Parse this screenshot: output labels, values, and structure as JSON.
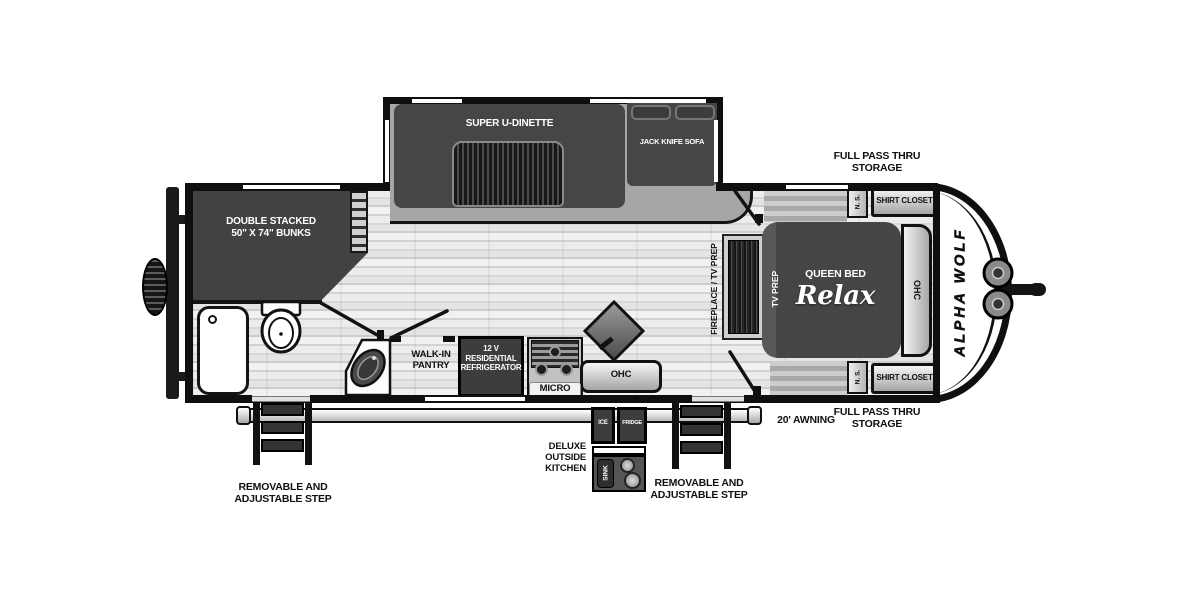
{
  "page": {
    "title": "Alpha Wolf travel trailer floor plan"
  },
  "colors": {
    "wall": "#0f0f0f",
    "furniture_dark": "#454545",
    "slide_floor": "#a6a6a6",
    "floor_light": "#e3e3e3"
  },
  "slide_out": {
    "dinette_label": "SUPER U-DINETTE",
    "sofa_label": "JACK KNIFE SOFA"
  },
  "bunk_room": {
    "line1": "DOUBLE STACKED",
    "line2": "50\" X 74\" BUNKS"
  },
  "kitchen": {
    "pantry_line1": "WALK-IN",
    "pantry_line2": "PANTRY",
    "fridge_line1": "12 V",
    "fridge_line2": "RESIDENTIAL",
    "fridge_line3": "REFRIGERATOR",
    "micro_label": "MICRO",
    "ohc_label": "OHC"
  },
  "bedroom": {
    "fireplace_label": "FIREPLACE / TV PREP",
    "tv_prep_label": "TV PREP",
    "bed_label": "QUEEN BED",
    "bed_script": "Relax",
    "ohc_label": "OHC",
    "ns_top": "N. S.",
    "ns_bottom": "N. S.",
    "shirt_closet_top": "SHIRT CLOSET",
    "shirt_closet_bottom": "SHIRT CLOSET"
  },
  "exterior": {
    "brand": "ALPHA WOLF",
    "pass_thru_top_1": "FULL PASS THRU",
    "pass_thru_top_2": "STORAGE",
    "pass_thru_bottom_1": "FULL PASS THRU",
    "pass_thru_bottom_2": "STORAGE",
    "awning_label": "20' AWNING",
    "step_left_1": "REMOVABLE AND",
    "step_left_2": "ADJUSTABLE STEP",
    "step_right_1": "REMOVABLE AND",
    "step_right_2": "ADJUSTABLE STEP",
    "outside_kitchen_1": "DELUXE",
    "outside_kitchen_2": "OUTSIDE",
    "outside_kitchen_3": "KITCHEN",
    "ice_label": "ICE",
    "out_fridge_label": "FRIDGE",
    "out_sink_label": "SINK"
  }
}
